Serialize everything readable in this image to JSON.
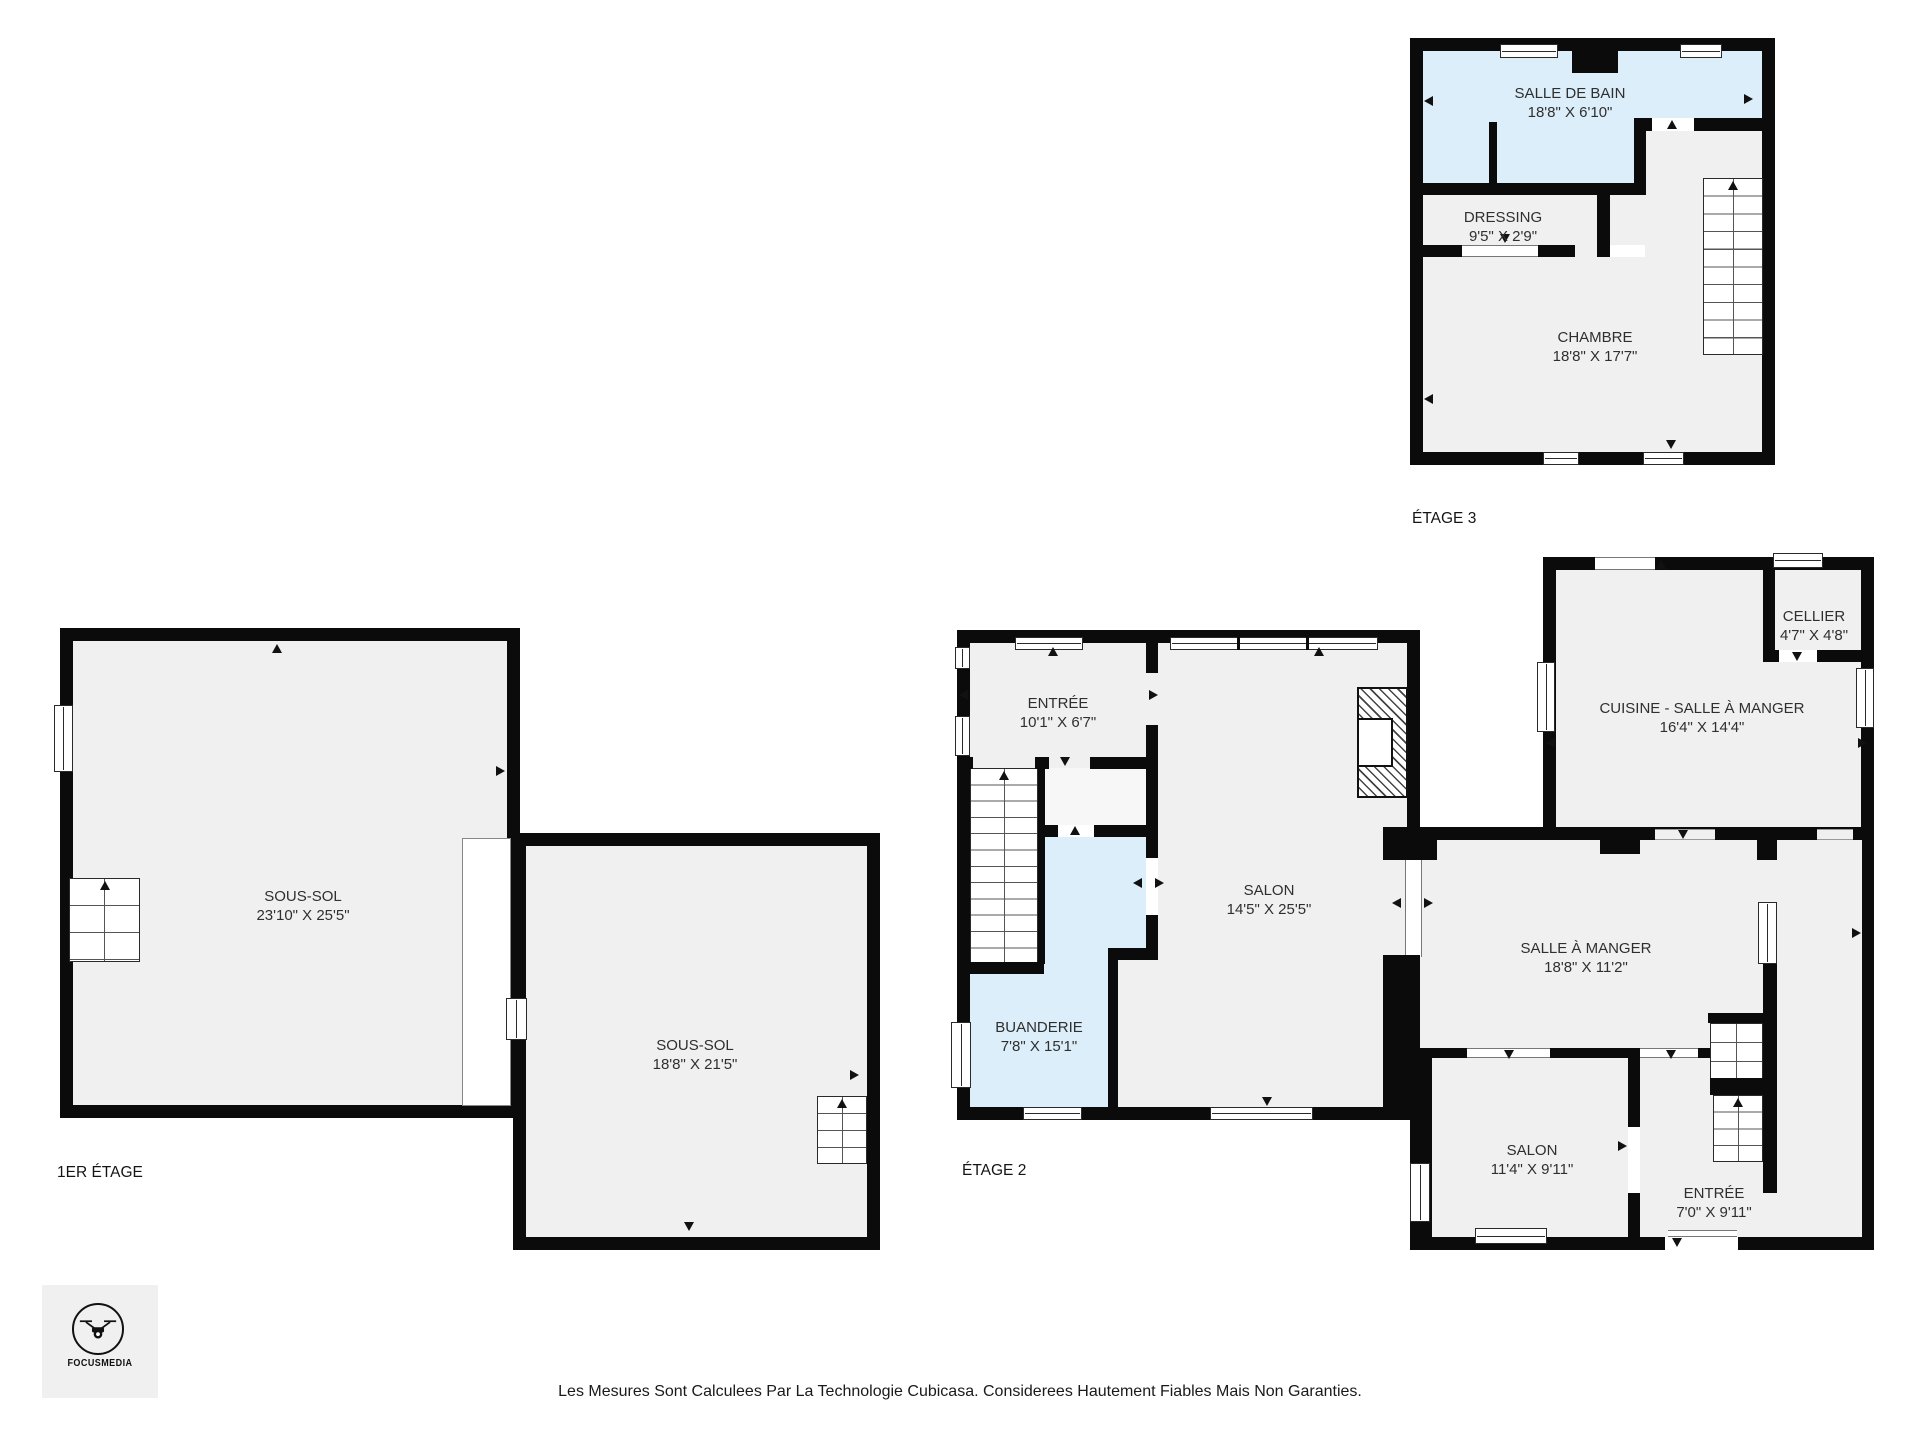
{
  "disclaimer": "Les Mesures Sont Calculees Par La Technologie Cubicasa. Considerees Hautement Fiables Mais Non Garanties.",
  "logo": {
    "brand": "FOCUSMEDIA"
  },
  "colors": {
    "wall": "#0b0b0b",
    "room": "#f0f0f0",
    "wet_room": "#dceef9",
    "background": "#ffffff"
  },
  "floors": [
    {
      "label": "ÉTAGE 3",
      "rooms": [
        {
          "name": "SALLE DE BAIN",
          "dims": "18'8\" X 6'10\""
        },
        {
          "name": "DRESSING",
          "dims": "9'5\" X 2'9\""
        },
        {
          "name": "CHAMBRE",
          "dims": "18'8\" X 17'7\""
        }
      ]
    },
    {
      "label": "1ER ÉTAGE",
      "rooms": [
        {
          "name": "SOUS-SOL",
          "dims": "23'10\" X 25'5\""
        },
        {
          "name": "SOUS-SOL",
          "dims": "18'8\" X 21'5\""
        }
      ]
    },
    {
      "label": "ÉTAGE 2",
      "rooms": [
        {
          "name": "ENTRÉE",
          "dims": "10'1\" X 6'7\""
        },
        {
          "name": "SALON",
          "dims": "14'5\" X 25'5\""
        },
        {
          "name": "BUANDERIE",
          "dims": "7'8\" X 15'1\""
        },
        {
          "name": "CELLIER",
          "dims": "4'7\" X 4'8\""
        },
        {
          "name": "CUISINE - SALLE À MANGER",
          "dims": "16'4\" X 14'4\""
        },
        {
          "name": "SALLE À MANGER",
          "dims": "18'8\" X 11'2\""
        },
        {
          "name": "SALON",
          "dims": "11'4\" X 9'11\""
        },
        {
          "name": "ENTRÉE",
          "dims": "7'0\" X 9'11\""
        }
      ]
    }
  ]
}
